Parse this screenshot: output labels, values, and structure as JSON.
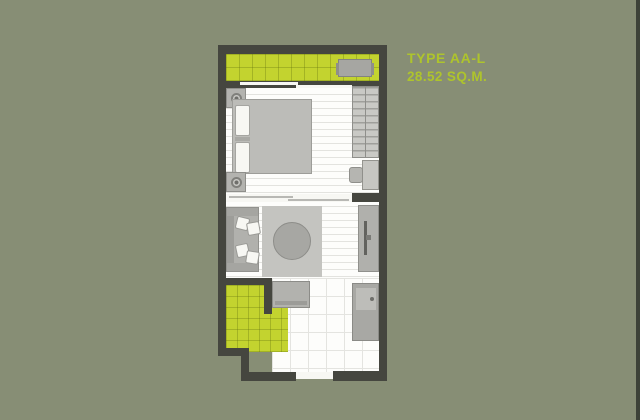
{
  "title": {
    "type_label": "TYPE AA-L",
    "area_label": "28.52 SQ.M."
  },
  "colors": {
    "background": "#878e75",
    "accent": "#c3d32f",
    "text_green": "#aec42c",
    "wall": "#45463f",
    "floor": "#fdfdfb",
    "rug": "#c4c4c0",
    "fur": "#bcbcb8",
    "edge": "#3d4238"
  },
  "floorplan": {
    "unit_type": "TYPE AA-L",
    "unit_area_sqm": "28.52",
    "rooms": [
      "balcony",
      "bedroom",
      "living-area",
      "bathroom",
      "kitchen-entry-hall"
    ],
    "furniture": [
      "ac-unit",
      "bed",
      "pillows",
      "nightstands",
      "lamps",
      "wardrobe",
      "desk",
      "stool",
      "sliding-partition",
      "sofa",
      "rug",
      "round-coffee-table",
      "tv-console",
      "tv",
      "cabinet",
      "kitchen-counter",
      "kitchen-sink",
      "fridge",
      "toilet",
      "bathroom-sink",
      "shower",
      "entry-door",
      "bathroom-door"
    ]
  }
}
